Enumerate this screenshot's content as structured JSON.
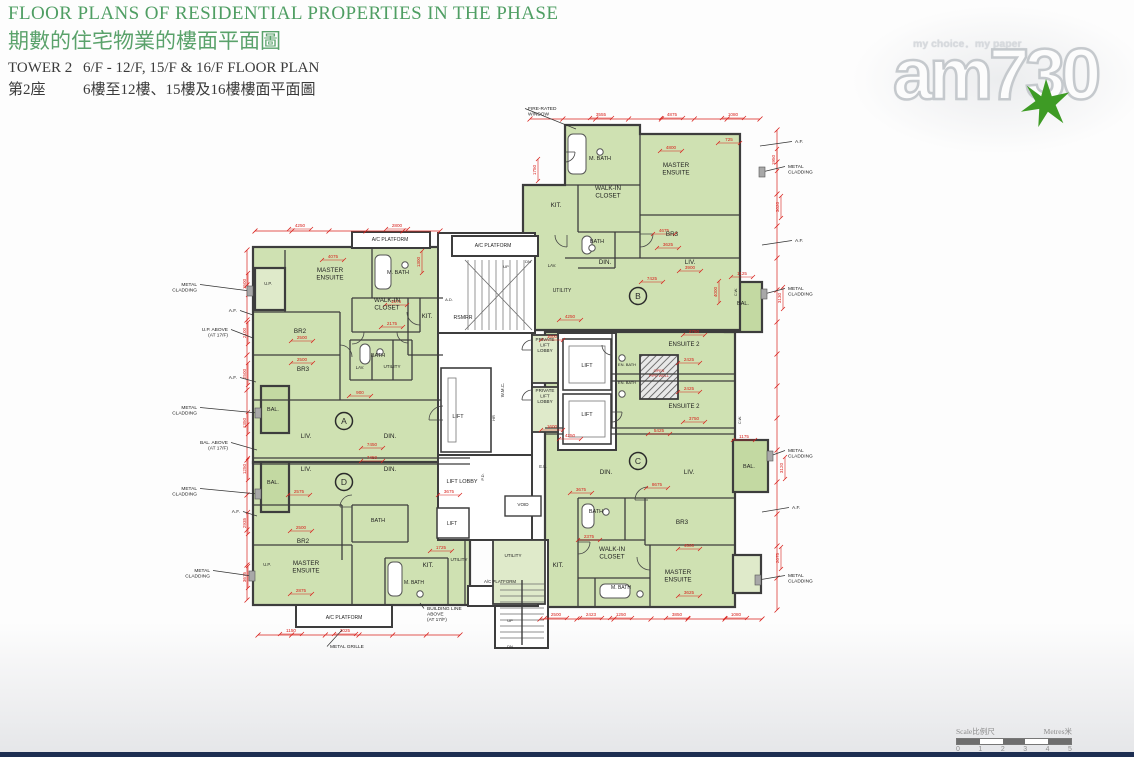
{
  "header": {
    "title_en": "FLOOR PLANS OF RESIDENTIAL PROPERTIES IN THE PHASE",
    "title_zh": "期數的住宅物業的樓面平面圖",
    "tower_en": "TOWER 2",
    "floors_en": "6/F - 12/F, 15/F & 16/F FLOOR PLAN",
    "tower_zh": "第2座",
    "floors_zh": "6樓至12樓、15樓及16樓樓面平面圖"
  },
  "watermark": {
    "tagline": "my choice．my paper",
    "logo": "am730"
  },
  "scale_bar": {
    "label_left": "Scale比例尺",
    "label_right": "Metres米",
    "ticks": [
      "0",
      "1",
      "2",
      "3",
      "4",
      "5"
    ]
  },
  "colors": {
    "title_green": "#4f9e63",
    "subtitle_green": "#5aa26b",
    "room": "#cfe1b2",
    "room_light": "#dfeaca",
    "balcony": "#c3d9a2",
    "wall": "#3d3d3d",
    "dim_red": "#d8201b",
    "strip_navy": "#1d2e52",
    "star_green": "#3e9b25",
    "logo_outline": "#c5c9cd",
    "scale_gray": "#8b8b8b"
  },
  "plan": {
    "badges": [
      [
        "A",
        344,
        421
      ],
      [
        "B",
        638,
        296
      ],
      [
        "C",
        638,
        461
      ],
      [
        "D",
        344,
        482
      ]
    ],
    "room_labels": [
      [
        "MASTER\nENSUITE",
        330,
        272
      ],
      [
        "M. BATH",
        398,
        274,
        5.5
      ],
      [
        "WALK-IN\nCLOSET",
        387,
        302
      ],
      [
        "KIT.",
        427,
        318
      ],
      [
        "BR2",
        300,
        333
      ],
      [
        "BR3",
        303,
        371
      ],
      [
        "BATH",
        378,
        357,
        5.5
      ],
      [
        "LAV.",
        360,
        369,
        4.2
      ],
      [
        "UTILITY",
        392,
        368,
        4.6
      ],
      [
        "LIV.",
        306,
        438
      ],
      [
        "DIN.",
        390,
        438
      ],
      [
        "LIV.",
        306,
        471
      ],
      [
        "DIN.",
        390,
        471
      ],
      [
        "BAL.",
        273,
        411,
        5.5
      ],
      [
        "BAL.",
        273,
        484,
        5.5
      ],
      [
        "U.P.",
        268,
        285,
        4.2
      ],
      [
        "U.P.",
        267,
        566,
        4.2
      ],
      [
        "BR2",
        303,
        543
      ],
      [
        "BATH",
        378,
        522,
        5.5
      ],
      [
        "MASTER\nENSUITE",
        306,
        565
      ],
      [
        "M. BATH",
        414,
        584,
        5
      ],
      [
        "KIT.",
        428,
        567
      ],
      [
        "UTILITY",
        459,
        561,
        4.6
      ],
      [
        "A/C PLATFORM",
        390,
        241,
        5
      ],
      [
        "A/C PLATFORM",
        493,
        247,
        5
      ],
      [
        "A/C PLATFORM",
        344,
        619,
        5
      ],
      [
        "A/C PLATFORM",
        500,
        583,
        4.4
      ],
      [
        "RSMRR",
        463,
        319,
        5.2
      ],
      [
        "A.D.",
        449,
        301,
        4
      ],
      [
        "LAV.",
        552,
        267,
        4.2
      ],
      [
        "UTILITY",
        562,
        292,
        5
      ],
      [
        "UP",
        506,
        268,
        4
      ],
      [
        "DN",
        528,
        263,
        4
      ],
      [
        "W.M.C.",
        504,
        390,
        4.4,
        -90
      ],
      [
        "HR",
        495,
        418,
        4,
        -90
      ],
      [
        "LIFT",
        458,
        418,
        5.5
      ],
      [
        "PRIVATE\nLIFT\nLOBBY",
        545,
        341,
        4.6
      ],
      [
        "PRIVATE\nLIFT\nLOBBY",
        545,
        392,
        4.6
      ],
      [
        "LIFT",
        587,
        367,
        5.5
      ],
      [
        "LIFT",
        587,
        416,
        5.5
      ],
      [
        "LIFT  LOBBY",
        462,
        483,
        5.5
      ],
      [
        "LIFT",
        452,
        525,
        5
      ],
      [
        "P.D.",
        484,
        477,
        4,
        -90
      ],
      [
        "E.L.",
        543,
        468,
        4.2
      ],
      [
        "VOID",
        523,
        506,
        4.6
      ],
      [
        "UP",
        510,
        622,
        4
      ],
      [
        "DN",
        510,
        648,
        4
      ],
      [
        "M. BATH",
        600,
        160,
        5.5
      ],
      [
        "MASTER\nENSUITE",
        676,
        167
      ],
      [
        "WALK-IN\nCLOSET",
        608,
        190
      ],
      [
        "KIT.",
        556,
        207
      ],
      [
        "BATH",
        597,
        243,
        5.5
      ],
      [
        "DIN.",
        605,
        264
      ],
      [
        "BR3",
        672,
        236
      ],
      [
        "LIV.",
        690,
        264
      ],
      [
        "BAL.",
        743,
        305,
        5.5
      ],
      [
        "ENSUITE 2",
        684,
        346,
        6
      ],
      [
        "ENSUITE 2",
        684,
        408,
        6
      ],
      [
        "EN. BATH",
        627,
        366,
        4
      ],
      [
        "EN. BATH",
        627,
        384,
        4
      ],
      [
        "OPEN\nPIPE WELL",
        659,
        372,
        3.8,
        0,
        "#c2241f"
      ],
      [
        "C.W.",
        737,
        292,
        3.8,
        -90
      ],
      [
        "C.W.",
        741,
        420,
        3.8,
        -90
      ],
      [
        "DIN.",
        606,
        474
      ],
      [
        "LIV.",
        689,
        474
      ],
      [
        "BATH",
        596,
        513,
        5.5
      ],
      [
        "BR3",
        682,
        524
      ],
      [
        "WALK-IN\nCLOSET",
        612,
        551
      ],
      [
        "KIT.",
        558,
        567
      ],
      [
        "UTILITY",
        513,
        557,
        4.6
      ],
      [
        "M. BATH",
        621,
        589,
        5
      ],
      [
        "MASTER\nENSUITE",
        678,
        574
      ],
      [
        "BAL.",
        749,
        468,
        5.5
      ]
    ],
    "dim_labels": [
      [
        "4250",
        300,
        227
      ],
      [
        "2800",
        397,
        227
      ],
      [
        "3555",
        601,
        116
      ],
      [
        "4875",
        672,
        116
      ],
      [
        "1080",
        733,
        116
      ],
      [
        "1750",
        536,
        170,
        -90
      ],
      [
        "4800",
        671,
        149
      ],
      [
        "725",
        729,
        141
      ],
      [
        "4675",
        664,
        232
      ],
      [
        "3625",
        668,
        246
      ],
      [
        "3900",
        690,
        269
      ],
      [
        "7425",
        652,
        280
      ],
      [
        "1125",
        742,
        275
      ],
      [
        "4000",
        717,
        292,
        -90
      ],
      [
        "1950",
        775,
        160,
        -90
      ],
      [
        "3020",
        779,
        207,
        -90
      ],
      [
        "3130",
        781,
        298,
        -90
      ],
      [
        "4075",
        333,
        258
      ],
      [
        "1300",
        420,
        262,
        -90
      ],
      [
        "1675",
        396,
        303
      ],
      [
        "2175",
        392,
        325
      ],
      [
        "2500",
        302,
        339
      ],
      [
        "2500",
        302,
        361
      ],
      [
        "900",
        360,
        394
      ],
      [
        "7450",
        372,
        446
      ],
      [
        "7450",
        372,
        459
      ],
      [
        "1500",
        246,
        284,
        -90
      ],
      [
        "2100",
        246,
        333,
        -90
      ],
      [
        "2500",
        246,
        374,
        -90
      ],
      [
        "1350",
        246,
        423,
        -90
      ],
      [
        "1250",
        246,
        469,
        -90
      ],
      [
        "2935",
        246,
        523,
        -90
      ],
      [
        "3675",
        246,
        577,
        -90
      ],
      [
        "2575",
        299,
        493
      ],
      [
        "3675",
        449,
        493
      ],
      [
        "2500",
        301,
        529
      ],
      [
        "2875",
        301,
        592
      ],
      [
        "1725",
        441,
        549
      ],
      [
        "1150",
        291,
        632
      ],
      [
        "3025",
        345,
        632
      ],
      [
        "4250",
        570,
        318
      ],
      [
        "1600",
        552,
        338
      ],
      [
        "4250",
        570,
        437
      ],
      [
        "1600",
        552,
        428
      ],
      [
        "2750",
        694,
        333
      ],
      [
        "2425",
        689,
        361
      ],
      [
        "2425",
        689,
        390
      ],
      [
        "3750",
        694,
        420
      ],
      [
        "5425",
        659,
        432
      ],
      [
        "1175",
        744,
        438
      ],
      [
        "3675",
        581,
        491
      ],
      [
        "8675",
        657,
        486
      ],
      [
        "2375",
        589,
        538
      ],
      [
        "4500",
        689,
        547
      ],
      [
        "3625",
        689,
        594
      ],
      [
        "2500",
        556,
        616
      ],
      [
        "2423",
        591,
        616
      ],
      [
        "1250",
        621,
        616
      ],
      [
        "3850",
        677,
        616
      ],
      [
        "1080",
        736,
        616
      ],
      [
        "3120",
        783,
        468,
        -90
      ],
      [
        "2075",
        779,
        558,
        -90
      ]
    ],
    "annotations": [
      [
        "METAL\nCLADDING",
        197,
        286,
        "e",
        250,
        291
      ],
      [
        "A.F.",
        237,
        312,
        "e",
        253,
        315
      ],
      [
        "U.P. ABOVE\n(AT 17/F)",
        228,
        331,
        "e",
        253,
        338
      ],
      [
        "A.F.",
        237,
        379,
        "e",
        256,
        382
      ],
      [
        "METAL\nCLADDING",
        197,
        409,
        "e",
        258,
        413
      ],
      [
        "BAL. ABOVE\n(AT 17/F)",
        228,
        444,
        "e",
        257,
        450
      ],
      [
        "METAL\nCLADDING",
        197,
        490,
        "e",
        258,
        494
      ],
      [
        "A.F.",
        240,
        513,
        "e",
        257,
        516
      ],
      [
        "METAL\nCLADDING",
        210,
        572,
        "e",
        252,
        576
      ],
      [
        "A.F.",
        795,
        143,
        "s",
        760,
        146
      ],
      [
        "METAL\nCLADDING",
        788,
        168,
        "s",
        762,
        172
      ],
      [
        "A.F.",
        795,
        242,
        "s",
        762,
        245
      ],
      [
        "METAL\nCLADDING",
        788,
        290,
        "s",
        764,
        294
      ],
      [
        "METAL\nCLADDING",
        788,
        452,
        "s",
        770,
        456
      ],
      [
        "A.F.",
        792,
        509,
        "s",
        762,
        512
      ],
      [
        "METAL\nCLADDING",
        788,
        577,
        "s",
        758,
        580
      ],
      [
        "FIRE-RATED\nWINDOW",
        528,
        110,
        "s",
        576,
        129
      ],
      [
        "METAL GRILLE",
        330,
        648,
        "s",
        342,
        630
      ],
      [
        "BUILDING LINE\nABOVE\n(AT 17/F)",
        427,
        610,
        "s",
        420,
        603
      ]
    ]
  }
}
